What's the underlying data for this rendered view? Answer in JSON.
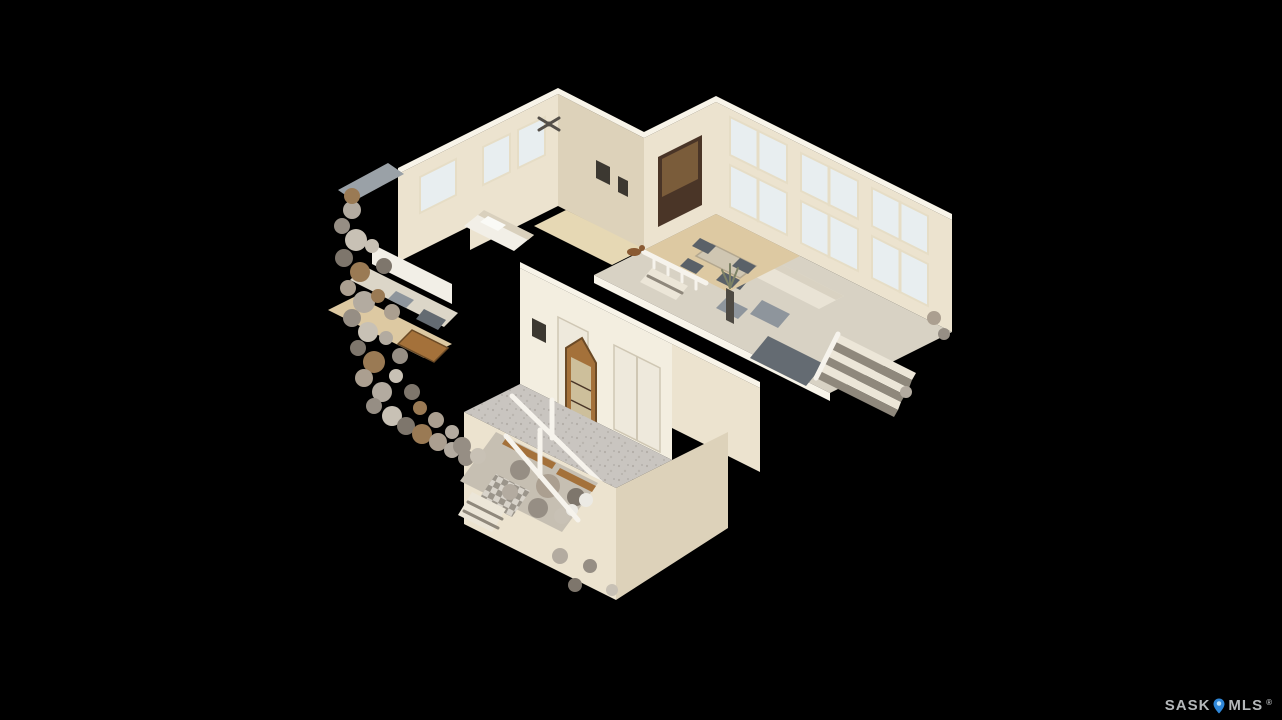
{
  "canvas": {
    "width": 1282,
    "height": 720
  },
  "scene": {
    "type": "3d-dollhouse-view",
    "subject": "two-storey residential interior cutaway on black background"
  },
  "watermark": {
    "brand_left": "SASK",
    "brand_right": "MLS",
    "registered": "®",
    "pin_icon": "location-pin-icon"
  },
  "palette": {
    "background": "#000000",
    "wall": "#ece3cf",
    "wall_bright": "#f3eee0",
    "wall_hi": "#f8f4e9",
    "wall_shade": "#ddd2ba",
    "white": "#f2efe7",
    "window": "#e8eef0",
    "window_frame": "#e6ddc6",
    "tile_floor": "#c9c5c0",
    "carpet": "#d8d2c4",
    "wood_floor": "#ddc9a2",
    "hall_wood": "#e6d8b4",
    "wood": "#a4713a",
    "wood_dark": "#4a3527",
    "counter": "#dcd6c8",
    "door": "#eee9dc",
    "door_edge": "#cfc7b4",
    "gray": "#8e959c",
    "gray_dark": "#5a6168",
    "slate": "#646b72",
    "slate_light": "#9aa1a7",
    "table": "#cfc6b2",
    "step_light": "#ece6d8",
    "step_dark": "#8f887c",
    "frame_dark": "#3c3831",
    "basement_floor": "#c6bfb2",
    "sofa": "#e9e3d5",
    "rail_white": "#f6f3ec",
    "clutter_a": "#b3aba0",
    "clutter_b": "#968e84",
    "clutter_c": "#c8c1b5",
    "clutter_d": "#7e766c",
    "clutter_e": "#9a7a54",
    "clutter_f": "#ab9f90",
    "watermark_text": "#b5b8ba",
    "pin_blue": "#2f87d8",
    "pin_light": "#bfe3fa"
  }
}
